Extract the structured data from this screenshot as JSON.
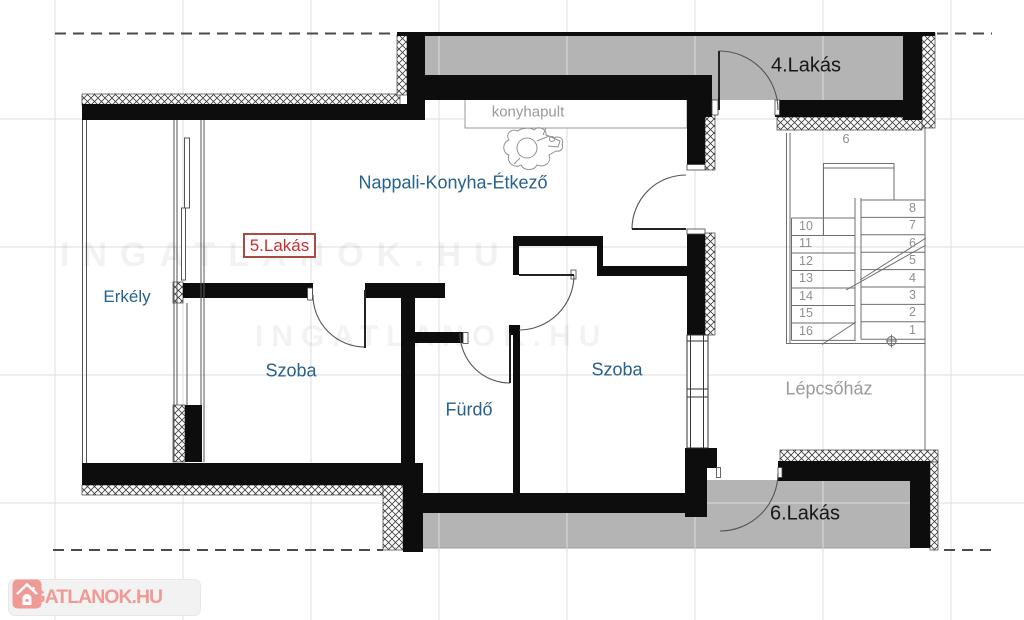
{
  "plan": {
    "rooms": {
      "nappali": "Nappali-Konyha-Étkező",
      "erkely": "Erkély",
      "szoba_left": "Szoba",
      "szoba_right": "Szoba",
      "furdo": "Fürdő",
      "lepcsohaz": "Lépcsőház",
      "kitchen_counter": "konyhapult"
    },
    "units": {
      "unit4": "4.Lakás",
      "unit5": "5.Lakás",
      "unit6": "6.Lakás"
    },
    "stairs": {
      "left_numbers": [
        "10",
        "11",
        "12",
        "13",
        "14",
        "15",
        "16"
      ],
      "right_numbers": [
        "8",
        "7",
        "6",
        "5",
        "4",
        "3",
        "2",
        "1"
      ],
      "landing_number": "9"
    },
    "watermark_text": "INGATLANOK.HU",
    "logo": {
      "brand": "INGATLANOK.HU"
    },
    "colors": {
      "room_label_blue": "#27618E",
      "unit_label_red": "#C5312E",
      "corridor_gray": "#B4B4B4",
      "muted_gray": "#9A9A9A",
      "logo_pink": "#ED9B94"
    }
  }
}
